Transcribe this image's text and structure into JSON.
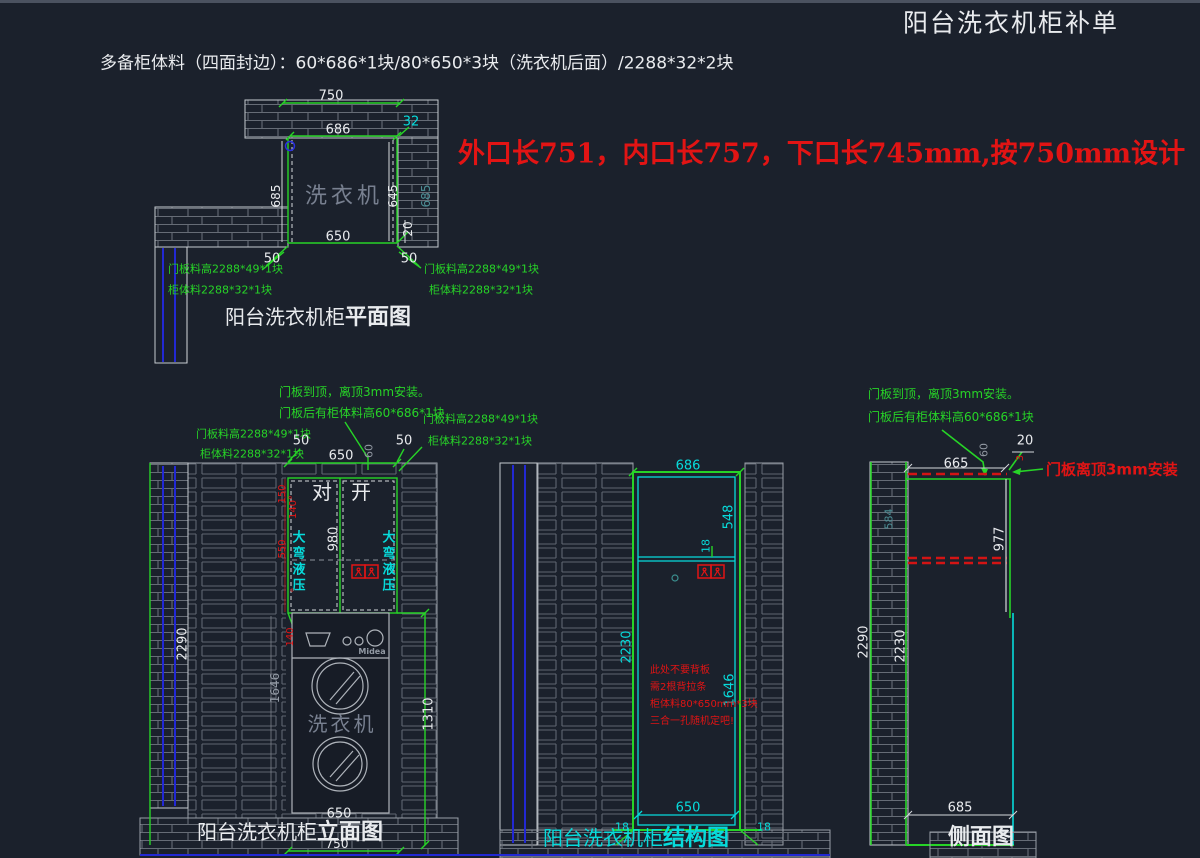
{
  "header": {
    "title": "阳台洗衣机柜补单",
    "materials_note": "多备柜体料（四面封边）：60*686*1块/80*650*3块（洗衣机后面）/2288*32*2块",
    "red_note": "外口长751，内口长757，下口长745mm,按750mm设计"
  },
  "colors": {
    "background": "#1b212c",
    "line_green": "#27d427",
    "line_cyan": "#07dbdb",
    "annotation_red": "#e21414",
    "wall_line_blue": "#2228d4",
    "text_white": "#e9ebee",
    "hatch_gray": "#666c76"
  },
  "plan_view": {
    "title_text": "阳台洗衣机柜",
    "title_suffix": "平面图",
    "machine_label": "洗衣机",
    "dim_750": "750",
    "dim_32": "32",
    "dim_686": "686",
    "dim_685_left": "685",
    "dim_645": "645",
    "dim_685_wall": "685",
    "dim_20": "20",
    "dim_650": "650",
    "dim_50_left": "50",
    "dim_50_right": "50",
    "leader_left_line1": "门板料高2288*49*1块",
    "leader_left_line2": "柜体料2288*32*1块",
    "leader_right_line1": "门板料高2288*49*1块",
    "leader_right_line2": "柜体料2288*32*1块"
  },
  "elevation_view": {
    "title_text": "阳台洗衣机柜",
    "title_suffix": "立面图",
    "note_line1": "门板到顶，离顶3mm安装。",
    "note_line2": "门板后有柜体料高60*686*1块",
    "leader_left_line1": "门板料高2288*49*1块",
    "leader_left_line2": "柜体料2288*32*1块",
    "leader_right_line1": "门板料高2288*49*1块",
    "leader_right_line2": "柜体料2288*32*1块",
    "dim_50_left": "50",
    "dim_650_top": "650",
    "dim_50_right": "50",
    "dim_60": "60",
    "door_left": "对",
    "door_right": "开",
    "dim_980": "980",
    "hinge_text": "大弯液压",
    "dim_150": "150",
    "dim_140_deg": "140°",
    "dim_550": "550",
    "deg_mark": "°",
    "dim_140": "140",
    "dim_2290": "2290",
    "dim_1646": "1646",
    "dim_1310": "1310",
    "brand": "Midea",
    "machine_label": "洗衣机",
    "dim_650_bottom": "650",
    "dim_750": "750"
  },
  "structure_view": {
    "title_text": "阳台洗衣机柜",
    "title_suffix": "结构图",
    "dim_686": "686",
    "dim_548": "548",
    "dim_18_shelf": "18",
    "dim_2230": "2230",
    "dim_1646": "1646",
    "red_note_line1": "此处不要背板",
    "red_note_line2": "需2根背拉条",
    "red_note_line3": "柜体料80*650mm*3块",
    "red_note_line4": "三合一孔随机定吧!",
    "dim_650": "650",
    "dim_18_left": "18",
    "dim_18_right": "18"
  },
  "side_view": {
    "title": "侧面图",
    "note_line1": "门板到顶，离顶3mm安装。",
    "note_line2": "门板后有柜体料高60*686*1块",
    "red_note": "门板离顶3mm安装",
    "dim_665": "665",
    "dim_20": "20",
    "dim_3": "3",
    "dim_60": "60",
    "dim_584": "584",
    "dim_977": "977",
    "dim_2290": "2290",
    "dim_2230": "2230",
    "dim_685": "685"
  }
}
